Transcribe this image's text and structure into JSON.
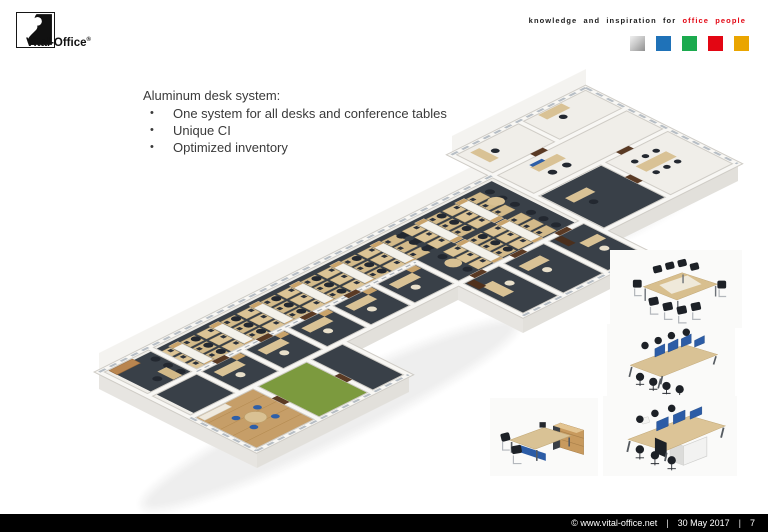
{
  "logo": {
    "brand": "Vital-Office",
    "registered_mark": "®"
  },
  "header": {
    "tagline_prefix": "knowledge and inspiration for",
    "tagline_highlight": "office people",
    "tagline_highlight_color": "#e30613",
    "brand_squares": [
      {
        "name": "silver",
        "color": "#c0c0c0"
      },
      {
        "name": "blue",
        "color": "#1f72b8"
      },
      {
        "name": "green",
        "color": "#1baa4e"
      },
      {
        "name": "red",
        "color": "#e30613"
      },
      {
        "name": "gold",
        "color": "#eaa500"
      }
    ]
  },
  "content": {
    "title": "Aluminum desk system:",
    "bullet_char": "•",
    "bullets": [
      "One system for all desks and conference tables",
      "Unique CI",
      "Optimized inventory"
    ]
  },
  "floorplan": {
    "description": "3D isometric rendering of an open-plan office floor: aluminum desk system workstations with white partition screens on dark carpet, glazed private offices, green lounge room, wooden kitchen area and meeting rooms",
    "colors": {
      "floor_dark": "#394048",
      "desk_wood": "#dac295",
      "wall_white": "#f8f7f4",
      "green_carpet": "#7c9a3e",
      "kitchen_wood": "#c69e68",
      "accent_blue": "#2e5fa8"
    }
  },
  "renders": [
    {
      "name": "conference-table",
      "description": "Conference table with black cantilever chairs"
    },
    {
      "name": "bench-desks-8",
      "description": "Eight-person bench desks with blue screens"
    },
    {
      "name": "executive-desk",
      "description": "Desk with blue modesty panel, cantilever chairs and wooden cabinet"
    },
    {
      "name": "bench-desks-6",
      "description": "Six-person bench desks with blue screens and white storage"
    }
  ],
  "footer": {
    "copyright": "© www.vital-office.net",
    "separator": "|",
    "date": "30 May 2017",
    "page": "7"
  }
}
